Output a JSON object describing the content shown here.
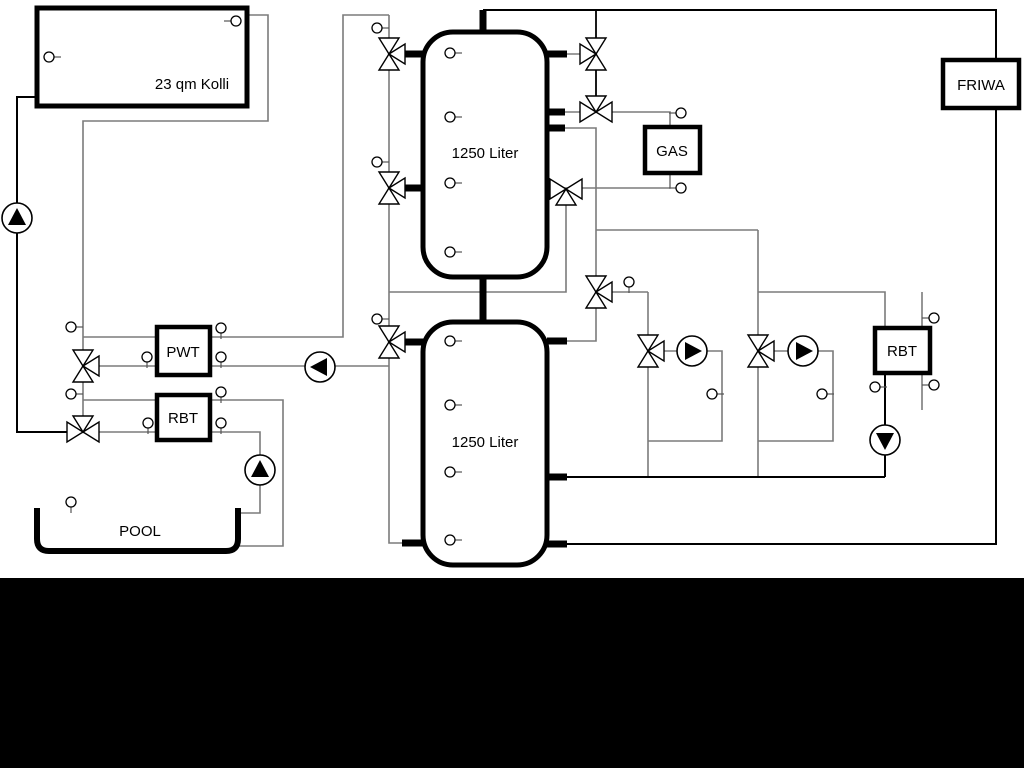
{
  "page": {
    "background": "#ffffff",
    "bottom_band_color": "#000000"
  },
  "colors": {
    "pipe_gray": "#7b7b7b",
    "pipe_black": "#000000",
    "component_stroke": "#000000",
    "component_fill": "#ffffff"
  },
  "labels": {
    "collector": "23 qm Kolli",
    "tank1": "1250 Liter",
    "tank2": "1250 Liter",
    "pwt": "PWT",
    "rbt_pool": "RBT",
    "gas": "GAS",
    "friwa": "FRIWA",
    "rbt_heating": "RBT",
    "pool": "POOL"
  },
  "components": {
    "pumps": [
      "collector-pump",
      "buffer-charge-pump",
      "pool-pump",
      "heating-circuit-1-pump",
      "heating-circuit-2-pump",
      "rbt-heating-pump"
    ],
    "valves": [
      "three-way-valve-tank1-top-left",
      "three-way-valve-tank1-mid-left",
      "three-way-valve-tank2-left",
      "three-way-valve-pwt-primary",
      "three-way-valve-pool-circuit",
      "three-way-valve-tank1-top-right",
      "three-way-valve-gas-supply",
      "three-way-valve-gas-return",
      "three-way-valve-heating-supply",
      "three-way-valve-heating-circuit-1",
      "three-way-valve-heating-circuit-2"
    ],
    "sensor_symbol": "temperature-sensor"
  }
}
